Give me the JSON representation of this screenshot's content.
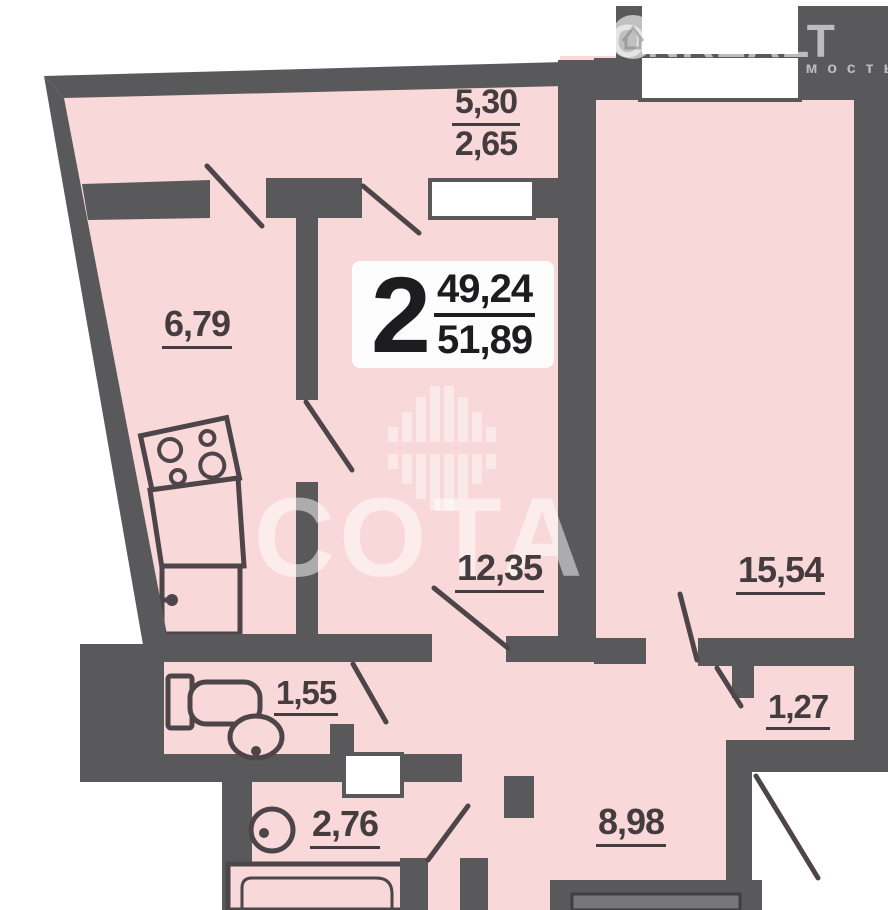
{
  "watermarks": {
    "brand": "ONREALT",
    "brand_sub": "недвижимость",
    "center_logo_text": "СОТА"
  },
  "unit_badge": {
    "rooms_count": "2",
    "value_top": "49,24",
    "value_bottom": "51,89"
  },
  "room_areas": {
    "balcony_top": {
      "value_top": "5,30",
      "value_bottom": "2,65"
    },
    "kitchen": "6,79",
    "living_room": "12,35",
    "bedroom": "15,54",
    "wc": "1,55",
    "closet": "1,27",
    "bathroom": "2,76",
    "hallway": "8,98"
  },
  "colors": {
    "room_fill": "#f9d8d9",
    "wall": "#59595c",
    "fixture_line": "#4d4549",
    "label_text": "#443c3e",
    "watermark": "#ffffff"
  }
}
